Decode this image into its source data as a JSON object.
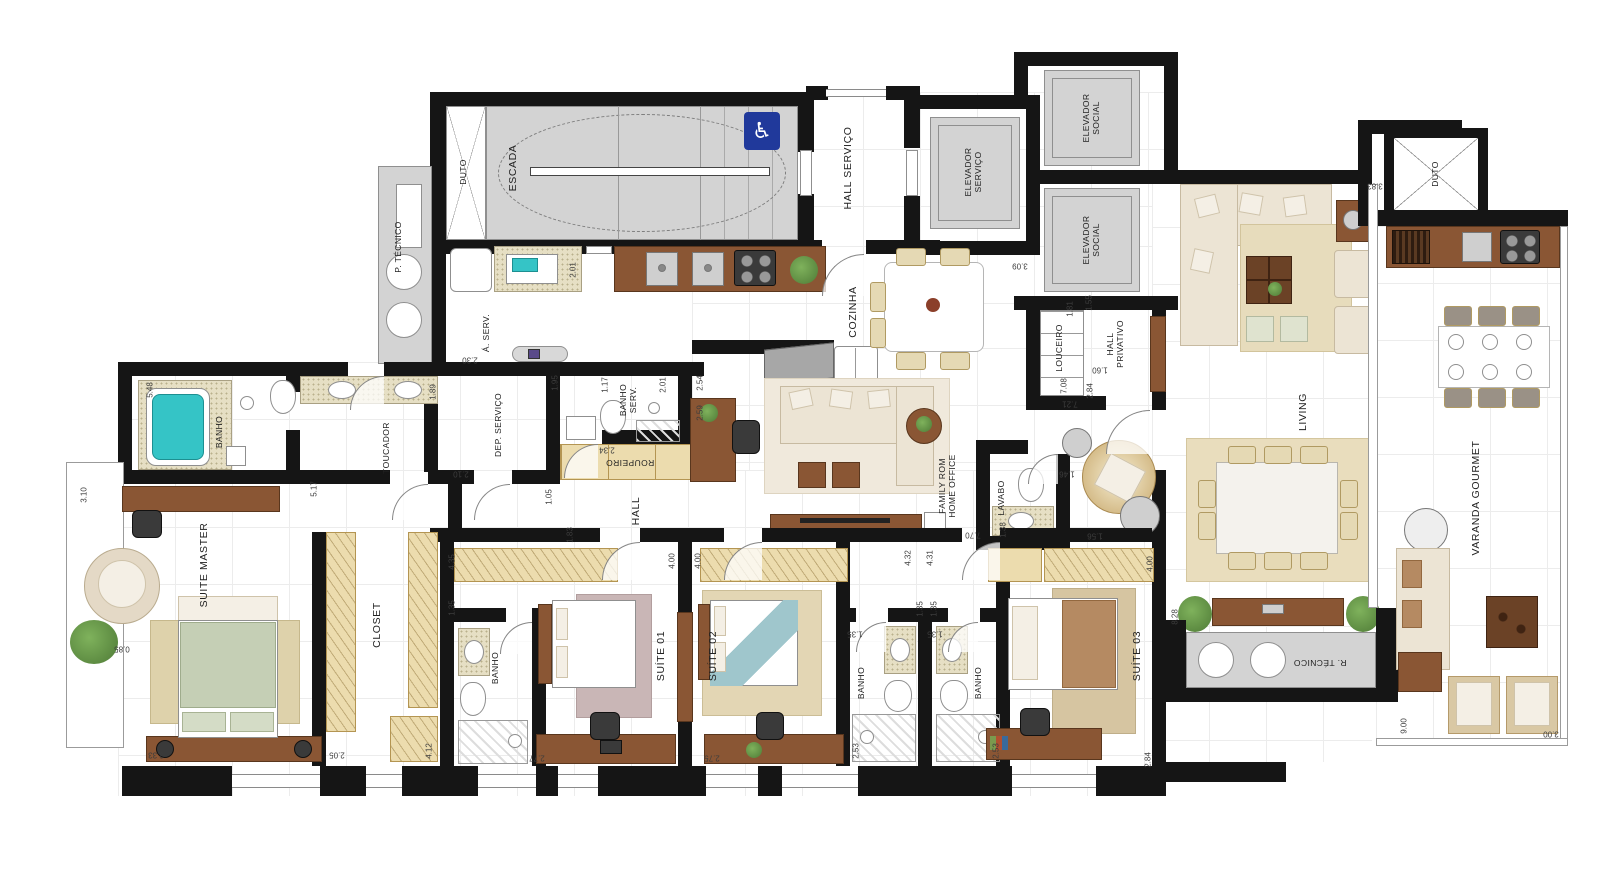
{
  "rooms": {
    "escada": "ESCADA",
    "duto_left": "DUTO",
    "duto_right": "DUTO",
    "p_tecnico": "P. TÉCNICO",
    "hall_servico": "HALL SERVIÇO",
    "elev_servico": "ELEVADOR\nSERVIÇO",
    "elev_social_1": "ELEVADOR\nSOCIAL",
    "elev_social_2": "ELEVADOR\nSOCIAL",
    "cozinha": "COZINHA",
    "louceiro": "LOUCEIRO",
    "hall_privativo": "HALL\nPRIVATIVO",
    "a_serv": "Á. SERV.",
    "dep_servico": "DEP. SERVIÇO",
    "banho_serv": "BANHO\nSERV.",
    "roupeiro": "ROUPEIRO",
    "hall": "HALL",
    "banho_master": "BANHO",
    "toucador": "TOUCADOR",
    "suite_master": "SUITE MASTER",
    "closet": "CLOSET",
    "banho_suite1": "BANHO",
    "suite_01": "SUÍTE 01",
    "suite_02": "SUÍTE 02",
    "banho_2a": "BANHO",
    "banho_2b": "BANHO",
    "suite_03": "SUÍTE 03",
    "family_office": "FAMILY ROM\nHOME OFFICE",
    "lavabo": "LAVABO",
    "living": "LIVING",
    "varanda_gourmet": "VARANDA GOURMET",
    "r_tecnico": "R. TÉCNICO"
  },
  "dims": [
    "5.48",
    "3.10",
    "0.85",
    "3.33",
    "2.05",
    "4.12",
    "1.35",
    "4.35",
    "1.89",
    "2.30",
    "2.10",
    "2.01",
    "1.95",
    "1.17",
    "2.01",
    "2.34",
    "1.05",
    "1.83",
    "2.54",
    "2.59",
    "4.00",
    "4.00",
    "2.77",
    "2.75",
    "4.32",
    "4.31",
    "1.35",
    "1.35",
    "1.35",
    "1.35",
    "2.53",
    "2.53",
    "2.84",
    "4.00",
    "7.70",
    "1.38",
    "1.46",
    "1.56",
    "1.81",
    "1.55",
    "1.60",
    "7.08",
    "2.84",
    "7.21",
    "3.09",
    "8.28",
    "9.00",
    "3.00",
    "3.83",
    "5.17"
  ],
  "icons": {
    "wheelchair": "♿"
  },
  "colors": {
    "wall": "#151515",
    "stair_fill": "#d3d3d3",
    "wood": "#8a5634",
    "cabinet_beige": "#ecdcae",
    "accessible_badge": "#20399b",
    "bathtub": "#35c4c6"
  }
}
